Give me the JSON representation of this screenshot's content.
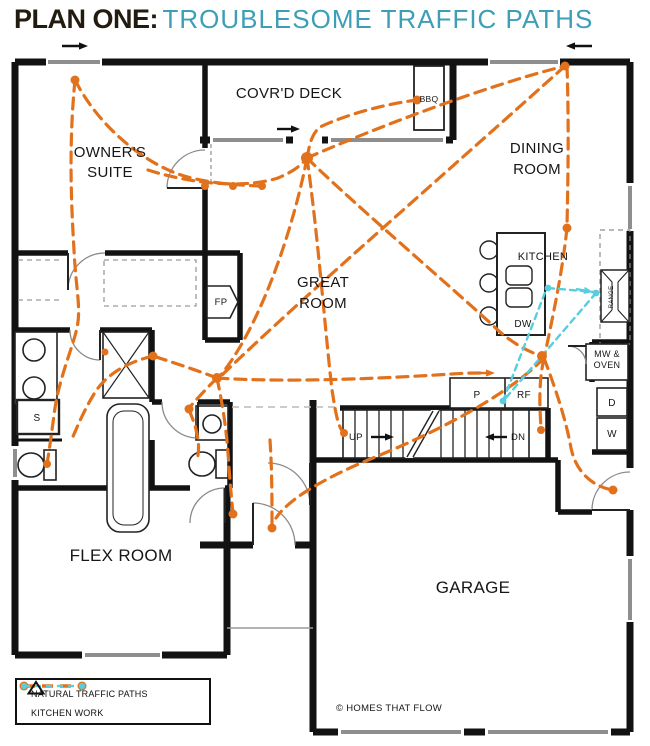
{
  "title": {
    "prefix": "PLAN ONE:",
    "main": "TROUBLESOME TRAFFIC PATHS"
  },
  "colors": {
    "traffic": "#E2711C",
    "kitchen": "#56CEDE",
    "accent": "#3D9FB5",
    "title": "#221B10",
    "wall": "#121212"
  },
  "legend": {
    "traffic_label": "NATURAL TRAFFIC PATHS",
    "kitchen_label": "KITCHEN WORK"
  },
  "plan": {
    "labels": [
      {
        "name": "label-owners-suite",
        "lines": [
          "OWNER'S",
          "SUITE"
        ],
        "x": 110,
        "y": 157,
        "size": 15,
        "lh": 20
      },
      {
        "name": "label-covrd-deck",
        "lines": [
          "COVR'D DECK"
        ],
        "x": 289,
        "y": 98,
        "size": 15
      },
      {
        "name": "label-bbq",
        "lines": [
          "BBQ"
        ],
        "x": 429,
        "y": 102,
        "size": 8.5
      },
      {
        "name": "label-dining-room",
        "lines": [
          "DINING",
          "ROOM"
        ],
        "x": 537,
        "y": 153,
        "size": 15,
        "lh": 21
      },
      {
        "name": "label-kitchen",
        "lines": [
          "KITCHEN"
        ],
        "x": 543,
        "y": 260,
        "size": 11
      },
      {
        "name": "label-dw",
        "lines": [
          "DW"
        ],
        "x": 523,
        "y": 327,
        "size": 10
      },
      {
        "name": "label-great-room",
        "lines": [
          "GREAT",
          "ROOM"
        ],
        "x": 323,
        "y": 287,
        "size": 15,
        "lh": 21
      },
      {
        "name": "label-fp",
        "lines": [
          "FP"
        ],
        "x": 221,
        "y": 305,
        "size": 9.5
      },
      {
        "name": "label-pantry",
        "lines": [
          "P"
        ],
        "x": 477,
        "y": 398,
        "size": 10
      },
      {
        "name": "label-rf",
        "lines": [
          "RF"
        ],
        "x": 524,
        "y": 398,
        "size": 10
      },
      {
        "name": "label-mw-oven",
        "lines": [
          "MW &",
          "OVEN"
        ],
        "x": 607,
        "y": 357,
        "size": 9,
        "lh": 11
      },
      {
        "name": "label-dryer",
        "lines": [
          "D"
        ],
        "x": 612,
        "y": 406,
        "size": 10
      },
      {
        "name": "label-washer",
        "lines": [
          "W"
        ],
        "x": 612,
        "y": 437,
        "size": 10
      },
      {
        "name": "label-shower",
        "lines": [
          "S"
        ],
        "x": 37,
        "y": 421,
        "size": 10
      },
      {
        "name": "label-up",
        "lines": [
          "UP"
        ],
        "x": 349,
        "y": 440,
        "size": 9.5,
        "anchor": "start"
      },
      {
        "name": "label-dn",
        "lines": [
          "DN"
        ],
        "x": 511,
        "y": 440,
        "size": 9.5,
        "anchor": "start"
      },
      {
        "name": "label-flex-room",
        "lines": [
          "FLEX ROOM"
        ],
        "x": 121,
        "y": 561,
        "size": 17
      },
      {
        "name": "label-garage",
        "lines": [
          "GARAGE"
        ],
        "x": 473,
        "y": 593,
        "size": 17
      },
      {
        "name": "label-range",
        "lines": [
          "RANGE"
        ],
        "x": 613,
        "y": 297,
        "size": 6,
        "rotate": -90
      },
      {
        "name": "label-copyright",
        "lines": [
          "© HOMES THAT FLOW"
        ],
        "x": 336,
        "y": 711,
        "size": 9.5,
        "anchor": "start"
      }
    ],
    "traffic_paths": [
      "M75,80 C68,150 72,215 74,250 C76,292 82,310 76,332 C70,355 58,382 54,415 C51,438 49,452 47,464",
      "M75,80 C98,125 140,160 178,174 C198,181 225,185 262,186",
      "M148,170 C185,182 240,190 278,178 C290,173 300,167 307,158",
      "M307,158 C310,142 312,134 320,127 C352,112 392,103 417,100",
      "M307,158 C375,128 488,85 565,66",
      "M307,158 C355,205 455,290 500,332 C518,347 532,353 542,356",
      "M307,158 C318,235 325,330 332,390 C336,415 338,426 343,432",
      "M307,158 C292,235 258,330 220,376",
      "M565,66 C455,165 305,295 222,375",
      "M567,66 C569,125 568,180 567,226",
      "M567,228 C562,275 552,320 545,354",
      "M544,358 C505,398 430,435 368,460 C330,476 290,497 276,518",
      "M544,358 C556,390 566,420 571,448 C576,472 592,486 612,490",
      "M544,358 C538,385 540,410 541,428",
      "M217,378 C226,420 228,450 229,468 C231,492 232,505 233,513",
      "M217,378 C196,370 172,362 153,356",
      "M217,378 C205,390 196,400 189,408",
      "M217,378 C290,383 390,378 452,374 C466,373 476,373 484,373",
      "M153,356 C128,362 106,374 94,394 C82,414 76,430 71,441",
      "M189,410 C197,428 201,445 197,460",
      "M270,440 C272,470 272,500 272,526"
    ],
    "traffic_dots": [
      [
        75,
        80,
        4.5
      ],
      [
        417,
        100,
        4.5
      ],
      [
        565,
        66,
        4.5
      ],
      [
        567,
        228,
        4.5
      ],
      [
        205,
        186,
        4
      ],
      [
        233,
        186,
        4
      ],
      [
        262,
        186,
        4
      ],
      [
        307,
        158,
        6
      ],
      [
        542,
        356,
        5
      ],
      [
        217,
        378,
        5
      ],
      [
        344,
        433,
        4
      ],
      [
        153,
        356,
        4.5
      ],
      [
        189,
        409,
        4.5
      ],
      [
        47,
        464,
        4
      ],
      [
        233,
        514,
        4.5
      ],
      [
        272,
        528,
        4.5
      ],
      [
        613,
        490,
        4.5
      ],
      [
        541,
        430,
        4
      ],
      [
        105,
        352,
        3.5
      ]
    ],
    "kitchen_paths": [
      "M548,288 L594,292",
      "M596,293 L504,400",
      "M503,401 L546,290"
    ],
    "kitchen_dots": [
      [
        548,
        288
      ],
      [
        596,
        293
      ],
      [
        503,
        401
      ]
    ],
    "arrows": [
      {
        "x1": 62,
        "y1": 46,
        "x2": 88,
        "y2": 46,
        "color": "black"
      },
      {
        "x1": 592,
        "y1": 46,
        "x2": 566,
        "y2": 46,
        "color": "black"
      },
      {
        "x1": 277,
        "y1": 129,
        "x2": 300,
        "y2": 129,
        "color": "black"
      },
      {
        "x1": 371,
        "y1": 437,
        "x2": 394,
        "y2": 437,
        "color": "black"
      },
      {
        "x1": 507,
        "y1": 437,
        "x2": 485,
        "y2": 437,
        "color": "black"
      },
      {
        "x1": 479,
        "y1": 373,
        "x2": 495,
        "y2": 373,
        "color": "traffic"
      },
      {
        "x1": 576,
        "y1": 289,
        "x2": 593,
        "y2": 292,
        "color": "kitchen"
      }
    ]
  }
}
